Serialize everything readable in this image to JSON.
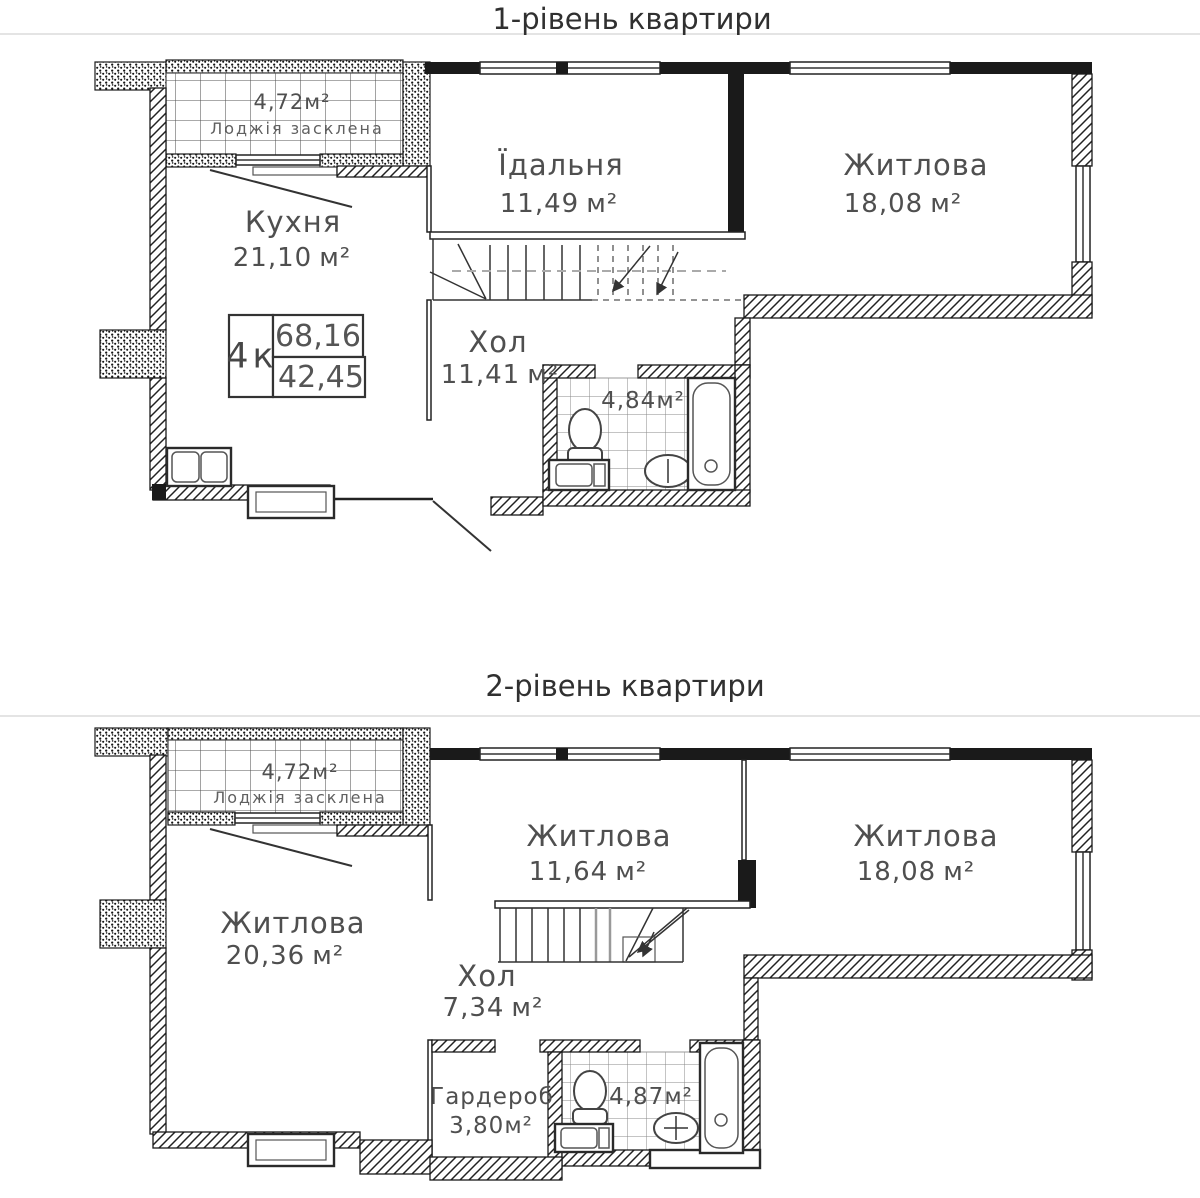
{
  "page": {
    "background": "#ffffff",
    "ink_color": "#1a1a1a",
    "label_color": "#4f4f4f"
  },
  "levels": [
    {
      "title": "1-рівень квартири",
      "unit_info": {
        "type": "4к",
        "total_area": "68,16",
        "living_area": "42,45"
      },
      "rooms": {
        "loggia": {
          "area": "4,72",
          "unit": "м²",
          "name": "Лоджія засклена"
        },
        "kitchen": {
          "name": "Кухня",
          "area": "21,10",
          "unit": "м²"
        },
        "dining": {
          "name": "Їдальня",
          "area": "11,49",
          "unit": "м²"
        },
        "living": {
          "name": "Житлова",
          "area": "18,08",
          "unit": "м²"
        },
        "hall": {
          "name": "Хол",
          "area": "11,41",
          "unit": "м²"
        },
        "bathroom": {
          "area": "4,84",
          "unit": "м²"
        }
      }
    },
    {
      "title": "2-рівень квартири",
      "rooms": {
        "loggia": {
          "area": "4,72",
          "unit": "м²",
          "name": "Лоджія засклена"
        },
        "living_left": {
          "name": "Житлова",
          "area": "20,36",
          "unit": "м²"
        },
        "living_mid": {
          "name": "Житлова",
          "area": "11,64",
          "unit": "м²"
        },
        "living_right": {
          "name": "Житлова",
          "area": "18,08",
          "unit": "м²"
        },
        "hall": {
          "name": "Хол",
          "area": "7,34",
          "unit": "м²"
        },
        "wardrobe": {
          "name": "Гардероб",
          "area": "3,80",
          "unit": "м²"
        },
        "bathroom": {
          "area": "4,87",
          "unit": "м²"
        }
      }
    }
  ]
}
